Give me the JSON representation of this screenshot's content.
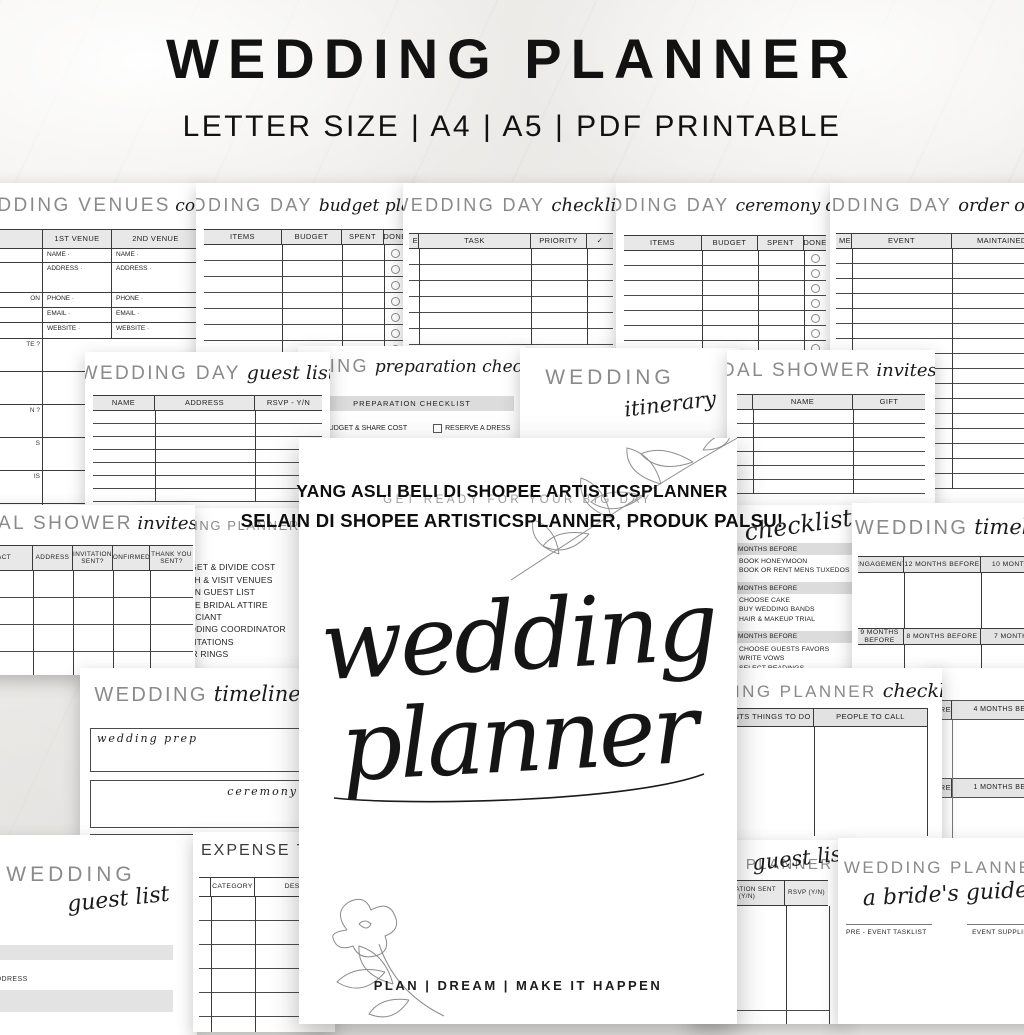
{
  "header": {
    "title": "WEDDING PLANNER",
    "subtitle": "LETTER SIZE | A4 | A5 | PDF PRINTABLE"
  },
  "watermark": {
    "line1": "YANG ASLI BELI DI SHOPEE ARTISTICSPLANNER",
    "line2": "SELAIN DI SHOPEE ARTISTICSPLANNER, PRODUK PALSU!"
  },
  "cover": {
    "tagline": "GET READY FOR YOUR BIG DAY",
    "title_word1": "wedding",
    "title_word2": "planner",
    "footer": "PLAN | DREAM | MAKE IT HAPPEN"
  },
  "cards": {
    "venues": {
      "title": "WEDDING VENUES",
      "script": "comparisons",
      "columns": [
        "1ST VENUE",
        "2ND VENUE"
      ],
      "fields": [
        "NAME ·",
        "ADDRESS ·",
        "PHONE ·",
        "EMAIL ·",
        "WEBSITE ·"
      ],
      "edge_fragment": "ON",
      "lower_fragments": [
        "TE ?",
        "N ?",
        "S",
        "IS",
        "NS"
      ]
    },
    "budget_planner": {
      "title": "WEDDING DAY",
      "script": "budget planner",
      "columns": [
        "ITEMS",
        "BUDGET",
        "SPENT",
        "DONE"
      ]
    },
    "day_checklist": {
      "title": "WEDDING DAY",
      "script": "checklist",
      "edge_fragment": "E",
      "columns": [
        "TASK",
        "PRIORITY",
        "✓"
      ]
    },
    "ceremony_decor": {
      "title": "WEDDING DAY",
      "script": "ceremony decor",
      "columns": [
        "ITEMS",
        "BUDGET",
        "SPENT",
        "DONE"
      ]
    },
    "order_of_events": {
      "title": "WEDDING DAY",
      "script": "order of events",
      "edge_fragment": "ME",
      "columns": [
        "EVENT",
        "MAINTAINED BY"
      ]
    },
    "day_guest_list": {
      "title": "WEDDING DAY",
      "script": "guest list",
      "columns": [
        "NAME",
        "ADDRESS",
        "RSVP - Y/N"
      ]
    },
    "preparation": {
      "title": "WEDDING",
      "script": "preparation checklist",
      "bar_label": "PREPARATION CHECKLIST",
      "items": [
        "BUDGET & SHARE COST",
        "RESERVE A DRESS"
      ]
    },
    "itinerary": {
      "title": "WEDDING",
      "script": "itinerary"
    },
    "shower_invites": {
      "title": "BRIDAL SHOWER",
      "script": "invites",
      "columns": [
        "NAME",
        "GIFT"
      ]
    },
    "shower_tracker": {
      "title": "BRIDAL SHOWER",
      "script": "invites",
      "columns": [
        "CONTACT",
        "ADDRESS",
        "INVITATION SENT?",
        "CONFIRMED?",
        "THANK YOU SENT?"
      ]
    },
    "planner_tasks": {
      "title": "WEDDING PLANNER",
      "items": [
        "SET DATE",
        "SET BUDGET & DIVIDE COST",
        "RESEARCH & VISIT VENUES",
        "DECIDE ON GUEST LIST",
        "PURCHASE BRIDAL ATTIRE",
        "FIND OFFICIANT",
        "HIRE WEDDING COORDINATOR",
        "SHOP INVITATIONS",
        "SHOP FOR RINGS"
      ]
    },
    "months_checklist": {
      "script": "checklist",
      "sections": [
        {
          "label": "MONTHS BEFORE",
          "items": [
            "BOOK HONEYMOON",
            "BOOK OR RENT MENS TUXEDOS"
          ]
        },
        {
          "label": "MONTHS BEFORE",
          "items": [
            "CHOOSE CAKE",
            "BUY WEDDING BANDS",
            "HAIR & MAKEUP TRIAL"
          ]
        },
        {
          "label": "MONTHS BEFORE",
          "items": [
            "CHOOSE GUESTS FAVORS",
            "WRITE VOWS",
            "SELECT READINGS"
          ]
        }
      ]
    },
    "timeline_grid": {
      "title": "WEDDING",
      "script": "timeline",
      "row1": [
        "ENGAGEMENT",
        "12 MONTHS BEFORE",
        "10 MONTHS BEFORE"
      ],
      "row2": [
        "9 MONTHS BEFORE",
        "8 MONTHS BEFORE",
        "7 MONTHS BEFORE"
      ]
    },
    "timeline_boxes": {
      "title": "WEDDING",
      "script": "timeline",
      "box1_label": "wedding prep",
      "box2_label": "ceremony"
    },
    "planner_checklist": {
      "title": "WEDDING PLANNER",
      "script": "checklist",
      "columns": [
        "EVENTS THINGS TO DO",
        "PEOPLE TO CALL"
      ]
    },
    "months_bars": {
      "rows": [
        {
          "left": "BEFORE",
          "right": "4 MONTHS BEFORE"
        },
        {
          "left": "BEFORE",
          "right": "1 MONTHS BEFORE"
        }
      ]
    },
    "guest_list_simple": {
      "title": "WEDDING",
      "script": "guest list",
      "field_label": "ADDRESS"
    },
    "expense_tracker": {
      "title": "EXPENSE TRACKER",
      "columns": [
        "CATEGORY",
        "DESCRIPTION"
      ]
    },
    "planner_guest_list": {
      "title": "WEDDING PLANNER",
      "script": "guest list",
      "columns": [
        "INVITATION SENT (Y/N)",
        "RSVP (Y/N)"
      ]
    },
    "brides_guide": {
      "title": "WEDDING PLANNER",
      "script": "a bride's guide",
      "left_label": "PRE - EVENT TASKLIST",
      "right_label": "EVENT SUPPLIERS"
    }
  }
}
